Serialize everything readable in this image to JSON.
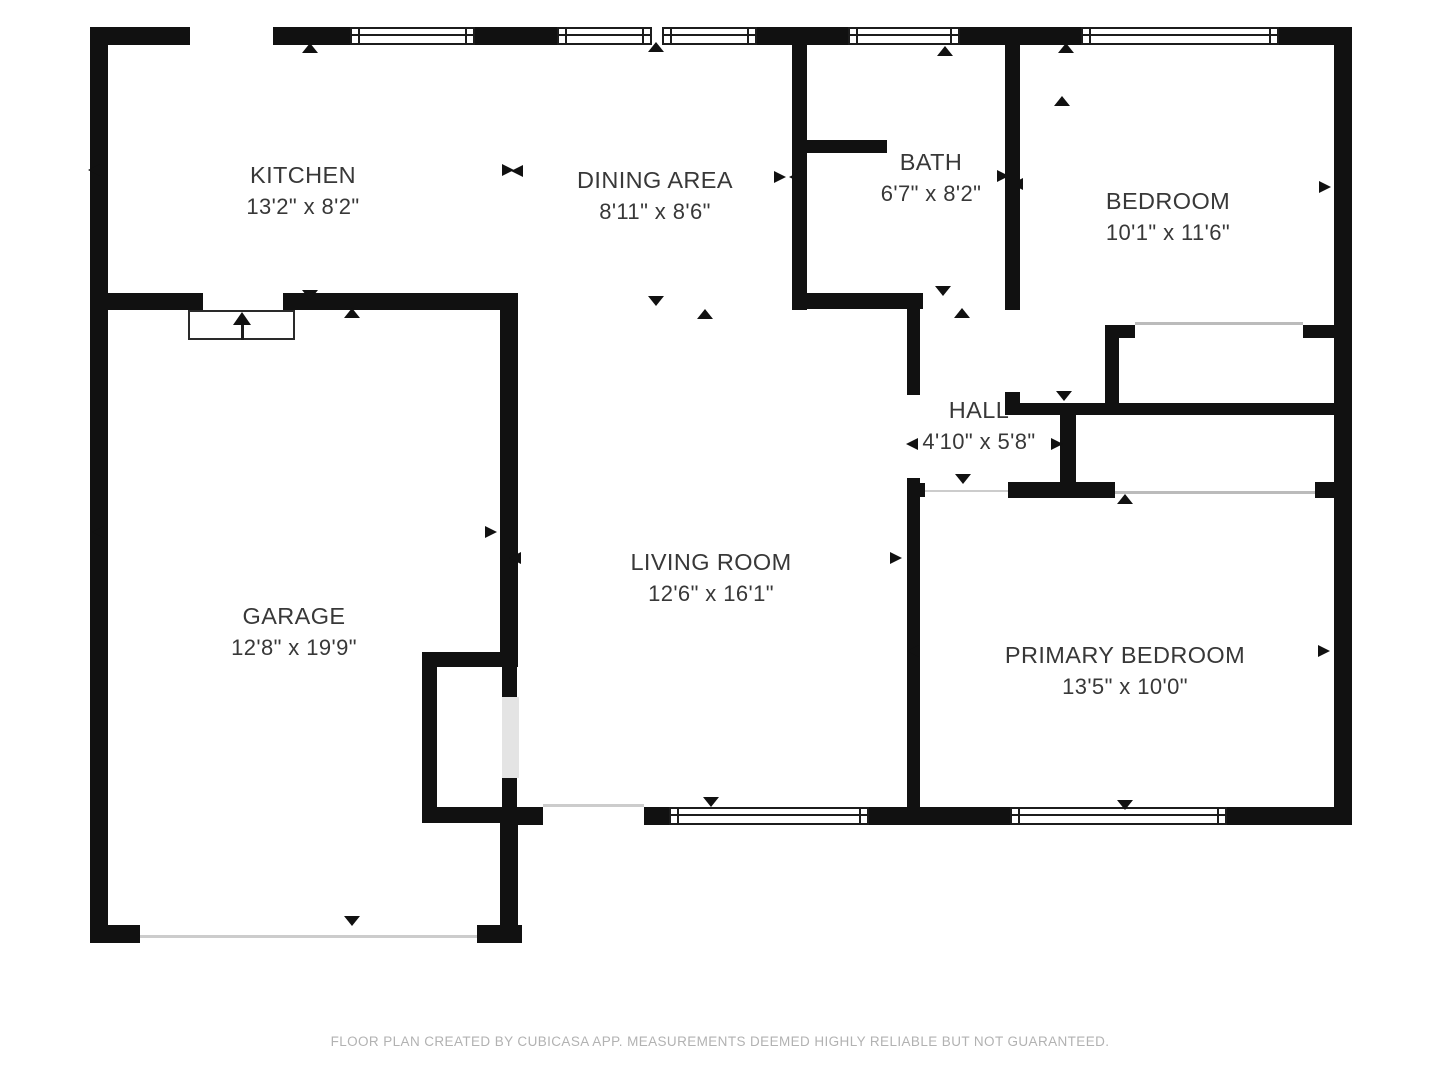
{
  "footer": {
    "disclaimer": "FLOOR PLAN CREATED BY CUBICASA APP. MEASUREMENTS DEEMED HIGHLY RELIABLE BUT NOT GUARANTEED."
  },
  "colors": {
    "wall": "#111111",
    "label_text": "#383838",
    "footer_text": "#b2b2b2",
    "slider_line": "#bbbbbb",
    "threshold_line": "#cccccc",
    "door_leaf": "#e4e4e4",
    "background": "#ffffff"
  },
  "rooms": [
    {
      "id": "kitchen",
      "name": "KITCHEN",
      "dims": "13'2\" x 8'2\"",
      "cx": 303,
      "cy": 191
    },
    {
      "id": "dining-area",
      "name": "DINING AREA",
      "dims": "8'11\" x 8'6\"",
      "cx": 655,
      "cy": 196
    },
    {
      "id": "bath",
      "name": "BATH",
      "dims": "6'7\" x 8'2\"",
      "cx": 931,
      "cy": 178
    },
    {
      "id": "bedroom",
      "name": "BEDROOM",
      "dims": "10'1\" x 11'6\"",
      "cx": 1168,
      "cy": 217
    },
    {
      "id": "hall",
      "name": "HALL",
      "dims": "4'10\" x 5'8\"",
      "cx": 979,
      "cy": 426
    },
    {
      "id": "garage",
      "name": "GARAGE",
      "dims": "12'8\" x 19'9\"",
      "cx": 294,
      "cy": 632
    },
    {
      "id": "living-room",
      "name": "LIVING ROOM",
      "dims": "12'6\" x 16'1\"",
      "cx": 711,
      "cy": 578
    },
    {
      "id": "primary-bedroom",
      "name": "PRIMARY BEDROOM",
      "dims": "13'5\" x 10'0\"",
      "cx": 1125,
      "cy": 671
    }
  ],
  "walls": [
    {
      "x": 90,
      "y": 27,
      "w": 100,
      "h": 18
    },
    {
      "x": 273,
      "y": 27,
      "w": 77,
      "h": 18
    },
    {
      "x": 475,
      "y": 27,
      "w": 82,
      "h": 18
    },
    {
      "x": 757,
      "y": 27,
      "w": 91,
      "h": 18
    },
    {
      "x": 960,
      "y": 27,
      "w": 121,
      "h": 18
    },
    {
      "x": 1279,
      "y": 27,
      "w": 73,
      "h": 18
    },
    {
      "x": 90,
      "y": 27,
      "w": 18,
      "h": 916
    },
    {
      "x": 1334,
      "y": 27,
      "w": 18,
      "h": 798
    },
    {
      "x": 90,
      "y": 925,
      "w": 50,
      "h": 18
    },
    {
      "x": 477,
      "y": 925,
      "w": 45,
      "h": 18
    },
    {
      "x": 907,
      "y": 807,
      "w": 103,
      "h": 18
    },
    {
      "x": 1227,
      "y": 807,
      "w": 125,
      "h": 18
    },
    {
      "x": 517,
      "y": 807,
      "w": 26,
      "h": 18
    },
    {
      "x": 644,
      "y": 807,
      "w": 25,
      "h": 18
    },
    {
      "x": 869,
      "y": 807,
      "w": 51,
      "h": 18
    },
    {
      "x": 792,
      "y": 27,
      "w": 15,
      "h": 283
    },
    {
      "x": 807,
      "y": 140,
      "w": 80,
      "h": 13
    },
    {
      "x": 792,
      "y": 293,
      "w": 131,
      "h": 16
    },
    {
      "x": 1005,
      "y": 27,
      "w": 15,
      "h": 283
    },
    {
      "x": 1005,
      "y": 392,
      "w": 15,
      "h": 23
    },
    {
      "x": 1010,
      "y": 403,
      "w": 342,
      "h": 12
    },
    {
      "x": 907,
      "y": 308,
      "w": 13,
      "h": 87
    },
    {
      "x": 907,
      "y": 478,
      "w": 13,
      "h": 347
    },
    {
      "x": 907,
      "y": 483,
      "w": 18,
      "h": 14
    },
    {
      "x": 90,
      "y": 293,
      "w": 113,
      "h": 17
    },
    {
      "x": 283,
      "y": 293,
      "w": 235,
      "h": 17
    },
    {
      "x": 500,
      "y": 310,
      "w": 18,
      "h": 357
    },
    {
      "x": 422,
      "y": 652,
      "w": 80,
      "h": 15
    },
    {
      "x": 422,
      "y": 652,
      "w": 15,
      "h": 171
    },
    {
      "x": 422,
      "y": 807,
      "w": 121,
      "h": 16
    },
    {
      "x": 502,
      "y": 667,
      "w": 15,
      "h": 32
    },
    {
      "x": 502,
      "y": 778,
      "w": 15,
      "h": 29
    },
    {
      "x": 500,
      "y": 823,
      "w": 18,
      "h": 120
    },
    {
      "x": 1008,
      "y": 482,
      "w": 107,
      "h": 16
    },
    {
      "x": 1315,
      "y": 482,
      "w": 19,
      "h": 16
    },
    {
      "x": 1060,
      "y": 415,
      "w": 16,
      "h": 68
    },
    {
      "x": 1105,
      "y": 325,
      "w": 30,
      "h": 13
    },
    {
      "x": 1303,
      "y": 325,
      "w": 31,
      "h": 13
    },
    {
      "x": 1105,
      "y": 338,
      "w": 14,
      "h": 65
    }
  ],
  "windows": [
    {
      "x": 350,
      "y": 27,
      "w": 125,
      "h": 18
    },
    {
      "x": 557,
      "y": 27,
      "w": 95,
      "h": 18
    },
    {
      "x": 662,
      "y": 27,
      "w": 95,
      "h": 18
    },
    {
      "x": 848,
      "y": 27,
      "w": 112,
      "h": 18
    },
    {
      "x": 1081,
      "y": 27,
      "w": 198,
      "h": 18
    },
    {
      "x": 669,
      "y": 807,
      "w": 200,
      "h": 18
    },
    {
      "x": 1010,
      "y": 807,
      "w": 217,
      "h": 18
    }
  ],
  "lines": [
    {
      "id": "bedroom-closet-slider",
      "x": 1135,
      "y": 322,
      "w": 168,
      "h": 3,
      "color": "slider_line"
    },
    {
      "id": "primary-closet-slider",
      "x": 1115,
      "y": 491,
      "w": 200,
      "h": 3,
      "color": "slider_line"
    },
    {
      "id": "hall-opening-threshold",
      "x": 925,
      "y": 490,
      "w": 83,
      "h": 2,
      "color": "threshold_line"
    },
    {
      "id": "patio-opening-threshold",
      "x": 543,
      "y": 804,
      "w": 101,
      "h": 3,
      "color": "threshold_line"
    },
    {
      "id": "garage-door-line",
      "x": 140,
      "y": 935,
      "w": 337,
      "h": 3,
      "color": "threshold_line"
    }
  ],
  "door_leaf": {
    "x": 502,
    "y": 697,
    "w": 17,
    "h": 81
  },
  "stairs": {
    "x": 188,
    "y": 310,
    "w": 107,
    "h": 30,
    "arrow_x": 242
  },
  "markers": [
    {
      "dir": "up",
      "x": 310,
      "y": 48
    },
    {
      "dir": "up",
      "x": 656,
      "y": 47
    },
    {
      "dir": "up",
      "x": 945,
      "y": 51
    },
    {
      "dir": "up",
      "x": 1066,
      "y": 48
    },
    {
      "dir": "up",
      "x": 1062,
      "y": 101
    },
    {
      "dir": "up",
      "x": 962,
      "y": 313
    },
    {
      "dir": "up",
      "x": 352,
      "y": 313
    },
    {
      "dir": "up",
      "x": 705,
      "y": 314
    },
    {
      "dir": "up",
      "x": 1125,
      "y": 499
    },
    {
      "dir": "down",
      "x": 310,
      "y": 295
    },
    {
      "dir": "down",
      "x": 656,
      "y": 301
    },
    {
      "dir": "down",
      "x": 943,
      "y": 291
    },
    {
      "dir": "down",
      "x": 1064,
      "y": 396
    },
    {
      "dir": "down",
      "x": 963,
      "y": 479
    },
    {
      "dir": "down",
      "x": 352,
      "y": 921
    },
    {
      "dir": "down",
      "x": 711,
      "y": 802
    },
    {
      "dir": "down",
      "x": 1125,
      "y": 805
    },
    {
      "dir": "left",
      "x": 100,
      "y": 170
    },
    {
      "dir": "left",
      "x": 523,
      "y": 171
    },
    {
      "dir": "left",
      "x": 801,
      "y": 177
    },
    {
      "dir": "left",
      "x": 1023,
      "y": 184
    },
    {
      "dir": "left",
      "x": 918,
      "y": 444
    },
    {
      "dir": "left",
      "x": 104,
      "y": 532
    },
    {
      "dir": "left",
      "x": 521,
      "y": 558
    },
    {
      "dir": "left",
      "x": 919,
      "y": 651
    },
    {
      "dir": "right",
      "x": 514,
      "y": 170
    },
    {
      "dir": "right",
      "x": 786,
      "y": 177
    },
    {
      "dir": "right",
      "x": 1009,
      "y": 176
    },
    {
      "dir": "right",
      "x": 1331,
      "y": 187
    },
    {
      "dir": "right",
      "x": 1063,
      "y": 444
    },
    {
      "dir": "right",
      "x": 497,
      "y": 532
    },
    {
      "dir": "right",
      "x": 902,
      "y": 558
    },
    {
      "dir": "right",
      "x": 1330,
      "y": 651
    }
  ]
}
